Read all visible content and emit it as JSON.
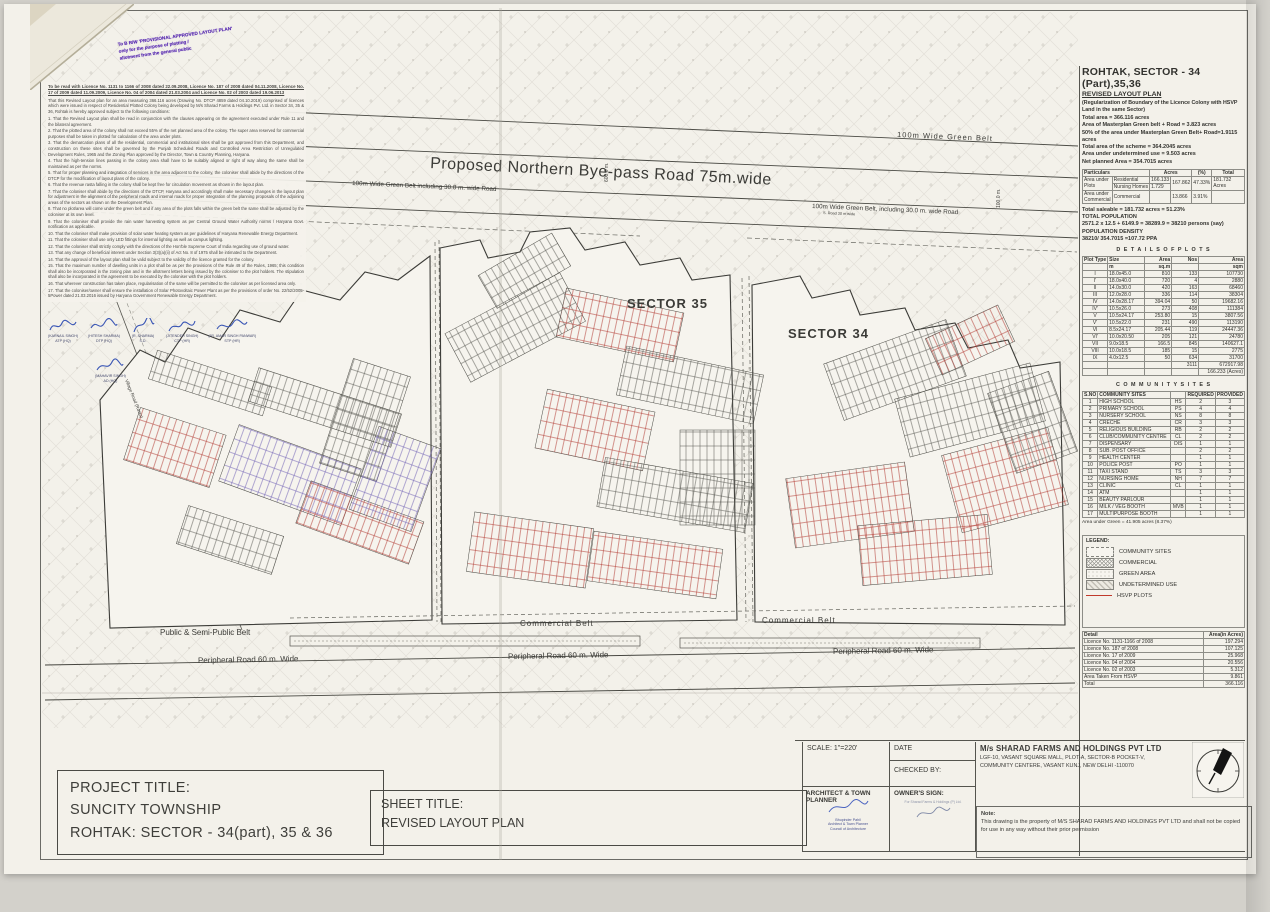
{
  "stamp": {
    "line1": "To B R/W 'PROVISIONAL APPROVED LAYOUT PLAN'",
    "line2": "only for the purpose of plotting /",
    "line3": "allotment from the general public"
  },
  "notes": {
    "header": "To be read with Licence No. 1131 to 1166 of 2008 dated 22.09.2008, Licence No. 187 of 2008 dated 04.11.2008, Licence No. 17 of 2009 dated 11.09.2009, Licence No. 04 of 2004 dated 21.03.2004 and Licence No. 02 of 2003 dated 19.06.2013",
    "intro": "That this Revised Layout plan for an area measuring 366.116 acres (Drawing No. DTCP 4859 dated 04.10.2019) comprised of licences which were issued in respect of Residential Plotted Colony being developed by M/s Sharad Farms & Holdings Pvt. Ltd. in Sector 34, 35 & 36, Rohtak is hereby approved subject to the following conditions:",
    "conditions": [
      "1.  That the Revised Layout plan shall be read in conjunction with the clauses appearing on the agreement executed under Rule 11 and the bilateral agreement.",
      "2.  That the plotted area of the colony shall not exceed 55% of the net planned area of the colony. The super area reserved for commercial purposes shall be taken in plotted for calculation of the area under plots.",
      "3.  That the demarcation plans of all the residential, commercial and institutional sites shall be got approved from this Department, and construction on these sites shall be governed by the Punjab Scheduled Roads and Controlled Area Restriction of Unregulated Development Rules, 1965 and the Zoning Plan approved by the Director, Town & Country Planning, Haryana.",
      "4.  That the high-tension lines passing in the colony area shall have to be suitably aligned or right of way along the same shall be maintained as per the norms.",
      "5.  That for proper planning and integration of services in the area adjacent to the colony, the coloniser shall abide by the directions of the DTCP for the modification of layout plans of the colony.",
      "6.  That the revenue rasta falling in the colony shall be kept free for circulation movement as shown in the layout plan.",
      "7.  That the coloniser shall abide by the directions of the DTCP, Haryana and accordingly shall make necessary changes in the layout plan for adjustment in the alignment of the peripheral roads and internal roads for proper integration of the planning proposals of the adjoining areas of the sectors as shown on the Development Plan.",
      "8.  That no plot/area will come under the green belt and if any area of the plots falls within the green belt the same shall be adjusted by the coloniser at its own level.",
      "9.  That the coloniser shall provide the rain water harvesting system as per Central Ground Water Authority norms / Haryana Govt. notification as applicable.",
      "10. That the coloniser shall make provision of solar water heating system as per guidelines of Haryana Renewable Energy Department.",
      "11. That the coloniser shall use only LED fittings for internal lighting as well as campus lighting.",
      "12. That the coloniser shall strictly comply with the directions of the Hon'ble Supreme Court of India regarding use of ground water.",
      "13. That any change of beneficial interest under Section 3(3)(a)(ii) of Act No. 8 of 1975 shall be intimated to the Department.",
      "14. That the approval of the layout plan shall be valid subject to the validity of the licence granted for the colony.",
      "15. That the maximum number of dwelling units in a plot shall be as per the provisions of the Rule 49 of the Rules, 1965; this condition shall also be incorporated in the zoning plan and in the allotment letters being issued by the coloniser to the plot holders. The stipulation shall also be incorporated in the agreement to be executed by the coloniser with the plot holders.",
      "16. That wherever construction has taken place, regularisation of the same will be permitted to the coloniser as per licensed area only.",
      "17. That the coloniser/owner shall ensure the installation of Solar Photovoltaic Power Plant as per the provisions of order No. 22/52/2005-5Power dated 21.03.2016 issued by Haryana Government Renewable Energy Department."
    ],
    "signatures": [
      {
        "name": "(KARNAIL SINGH)",
        "desig": "ATP (HQ)"
      },
      {
        "name": "(HITESH SHARMA)",
        "desig": "DTP (HQ)"
      },
      {
        "name": "(R. SHARMA)",
        "desig": "S.D."
      },
      {
        "name": "(JITENDER SINGH)",
        "desig": "CTP (HR)"
      },
      {
        "name": "(JR. AMAR SINGH PANWAR)",
        "desig": "STP (HR)"
      },
      {
        "name": "(MAHAVIR SINGH)",
        "desig": "AD (HQ)"
      }
    ]
  },
  "map": {
    "labels": {
      "green_belt_top": "100m Wide  Green Belt",
      "byepass": "Proposed Northern Bye-pass Road 75m.wide",
      "green_belt_left": "100m Wide  Green Belt  including 30.0 m. wide  Road",
      "green_belt_right": "100m Wide  Green Belt, including 30.0 m. wide  Road",
      "road30_left": "Road 30 m wide",
      "road30_right": "S. Road 30 m wide",
      "dim600": "600.0 m.",
      "dim100": "100.0 m.",
      "sector35": "SECTOR 35",
      "sector34": "SECTOR 34",
      "village_road": "Village Road (Rasta)",
      "public_semi": "Public  &   Semi-Public Belt",
      "commercial1": "Commercial   Belt",
      "commercial2": "Commercial   Belt",
      "peripheral1": "Peripheral Road 60 m. Wide",
      "peripheral2": "Peripheral Road 60 m. Wide",
      "peripheral3": "Peripheral Road 60 m. Wide"
    }
  },
  "panel": {
    "title": "ROHTAK, SECTOR - 34 (Part),35,36",
    "subtitle": "REVISED LAYOUT PLAN",
    "regnote": "(Regularization of Boundary of the Licence Colony with HSVP Land in the same Sector)",
    "summary": [
      "Total area  = 366.116 acres",
      "Area of Masterplan Green belt + Road = 3.823 acres",
      "50% of the area under Masterplan Green Belt+ Road=1.9115 acres",
      "Total area of the scheme = 364.2045 acres",
      "Area under undetermined use = 9.503 acres",
      "Net planned Area = 354.7015 acres"
    ],
    "particulars": {
      "h_part": "Particulars",
      "h_acres": "Acres",
      "h_pct": "(%)",
      "h_total": "Total",
      "r1c1": "Area under Plots",
      "r1c2": "Residential",
      "r1v": "166.133",
      "sub": "167.862",
      "pct": "47.33%",
      "total": "181.732 Acres",
      "r2c2": "Nursing Homes",
      "r2v": "1.729",
      "r3c1": "Area under Commercial",
      "r3c2": "Commercial",
      "r3v": "13.866",
      "r3pct": "3.91%"
    },
    "saleable": [
      "Total saleable = 181.732 acres = 51.23%",
      "TOTAL POPULATION",
      "2571.2 x 12.5 + 6149.9 = 38289.9 = 38210 persons (say)",
      "POPULATION DENSITY",
      "38210/ 354.7015 =107.72 PPA"
    ],
    "details": {
      "title": "D E T A I L S   O F   P L O T S",
      "headers": [
        [
          "Plot Type",
          "Size",
          "Area",
          "Nos",
          "Area"
        ],
        [
          "",
          "m",
          "sq.m",
          "",
          "sqm"
        ]
      ],
      "rows": [
        [
          "I",
          "18.0x45.0",
          "810",
          "133",
          "107730"
        ],
        [
          "I'",
          "18.0x40.0",
          "720",
          "4",
          "2880"
        ],
        [
          "II",
          "14.0x30.0",
          "420",
          "163",
          "68460"
        ],
        [
          "III",
          "12.0x28.0",
          "336",
          "114",
          "38304"
        ],
        [
          "IV",
          "14.0x28.17",
          "394.04",
          "50",
          "19682.16"
        ],
        [
          "IV'",
          "10.5x26.0",
          "273",
          "408",
          "111384"
        ],
        [
          "V",
          "10.5x24.17",
          "253.80",
          "15",
          "3807.56"
        ],
        [
          "V'",
          "10.5x22.0",
          "231",
          "490",
          "113190"
        ],
        [
          "VI",
          "8.5x24.17",
          "205.44",
          "119",
          "24447.36"
        ],
        [
          "VI'",
          "10.0x20.50",
          "205",
          "121",
          "24780"
        ],
        [
          "VII",
          "9.0x18.5",
          "166.5",
          "845",
          "140627.1"
        ],
        [
          "VIII",
          "10.0x18.5",
          "185",
          "15",
          "2775"
        ],
        [
          "IX",
          "4.0x12.5",
          "50",
          "634",
          "31700"
        ],
        [
          "",
          "",
          "",
          "3111",
          "672917.98"
        ],
        [
          "",
          "",
          "",
          "",
          "166.233 (Acres)"
        ]
      ]
    },
    "community": {
      "title": "C O M M U N I T Y   S I T E S",
      "headers": [
        [
          "S.NO",
          "COMMUNITY SITES",
          "",
          "REQUIRED",
          "PROVIDED"
        ]
      ],
      "rows": [
        [
          "1",
          "HIGH SCHOOL",
          "HS",
          "2",
          "3"
        ],
        [
          "2",
          "PRIMARY SCHOOL",
          "PS",
          "4",
          "4"
        ],
        [
          "3",
          "NURSERY SCHOOL",
          "NS",
          "8",
          "8"
        ],
        [
          "4",
          "CRECHE",
          "CR",
          "3",
          "3"
        ],
        [
          "5",
          "RELIGIOUS BUILDING",
          "RB",
          "2",
          "2"
        ],
        [
          "6",
          "CLUB/COMMUNITY CENTRE",
          "CL",
          "2",
          "2"
        ],
        [
          "7",
          "DISPENSARY",
          "DIS",
          "1",
          "1"
        ],
        [
          "8",
          "SUB. POST OFFICE",
          "",
          "2",
          "2"
        ],
        [
          "9",
          "HEALTH CENTER",
          "",
          "1",
          "1"
        ],
        [
          "10",
          "POLICE POST",
          "PO",
          "1",
          "1"
        ],
        [
          "11",
          "TAXI STAND",
          "TS",
          "3",
          "3"
        ],
        [
          "12",
          "NURSING HOME",
          "NH",
          "7",
          "7"
        ],
        [
          "13",
          "CLINIC",
          "CL",
          "1",
          "1"
        ],
        [
          "14",
          "ATM",
          "",
          "1",
          "1"
        ],
        [
          "15",
          "BEAUTY PARLOUR",
          "",
          "1",
          "1"
        ],
        [
          "16",
          "MILK / VEG BOOTH",
          "MVB",
          "1",
          "1"
        ],
        [
          "17",
          "MULTIPURPOSE BOOTH",
          "",
          "1",
          "1"
        ]
      ]
    },
    "green_note": "Area under Green = 41.905 acres (8.37%)",
    "legend": {
      "title": "LEGEND:",
      "items": [
        "COMMUNITY SITES",
        "COMMERCIAL",
        "GREEN AREA",
        "UNDETERMINED USE",
        "HSVP PLOTS"
      ]
    },
    "licences": {
      "headers": [
        [
          "Detail",
          "Area(in Acres)"
        ]
      ],
      "rows": [
        [
          "Licence No. 1131-1166 of 2008",
          "197.294"
        ],
        [
          "Licence No. 187 of 2008",
          "107.125"
        ],
        [
          "Licence No. 17 of 2009",
          "25.968"
        ],
        [
          "Licence No. 04 of 2004",
          "20.556"
        ],
        [
          "Licence No. 02 of 2003",
          "5.312"
        ],
        [
          "Area Taken From HSVP",
          "9.861"
        ],
        [
          "Total",
          "366.116"
        ]
      ]
    }
  },
  "titleblock": {
    "scale": "SCALE: 1\"=220'",
    "date_label": "DATE",
    "checked": "CHECKED BY:",
    "architect": "ARCHITECT & TOWN PLANNER",
    "owner": "OWNER'S SIGN:",
    "company_name": "M/s SHARAD FARMS AND HOLDINGS PVT LTD",
    "addr1": "LGF-10, VASANT SQUARE MALL, PLOT-A, SECTOR-B  POCKET-V,",
    "addr2": "COMMUNITY CENTERE, VASANT KUNJ, NEW DELHI -110070",
    "note_label": "Note:",
    "note_text": "This drawing is the property of M/S SHARAD FARMS AND HOLDINGS PVT LTD and shall not be copied for use in any way without their prior permission",
    "project_label": "PROJECT TITLE:",
    "project1": "SUNCITY  TOWNSHIP",
    "project2": "ROHTAK: SECTOR - 34(part), 35 & 36",
    "sheet_label": "SHEET TITLE:",
    "sheet1": "REVISED LAYOUT PLAN",
    "arch1": "Bhupinder Pahil",
    "arch2": "Architect & Town Planner",
    "arch3": "Council of Architecture",
    "owner_sig": "For Sharad Farms & Holdings (P) Ltd."
  }
}
